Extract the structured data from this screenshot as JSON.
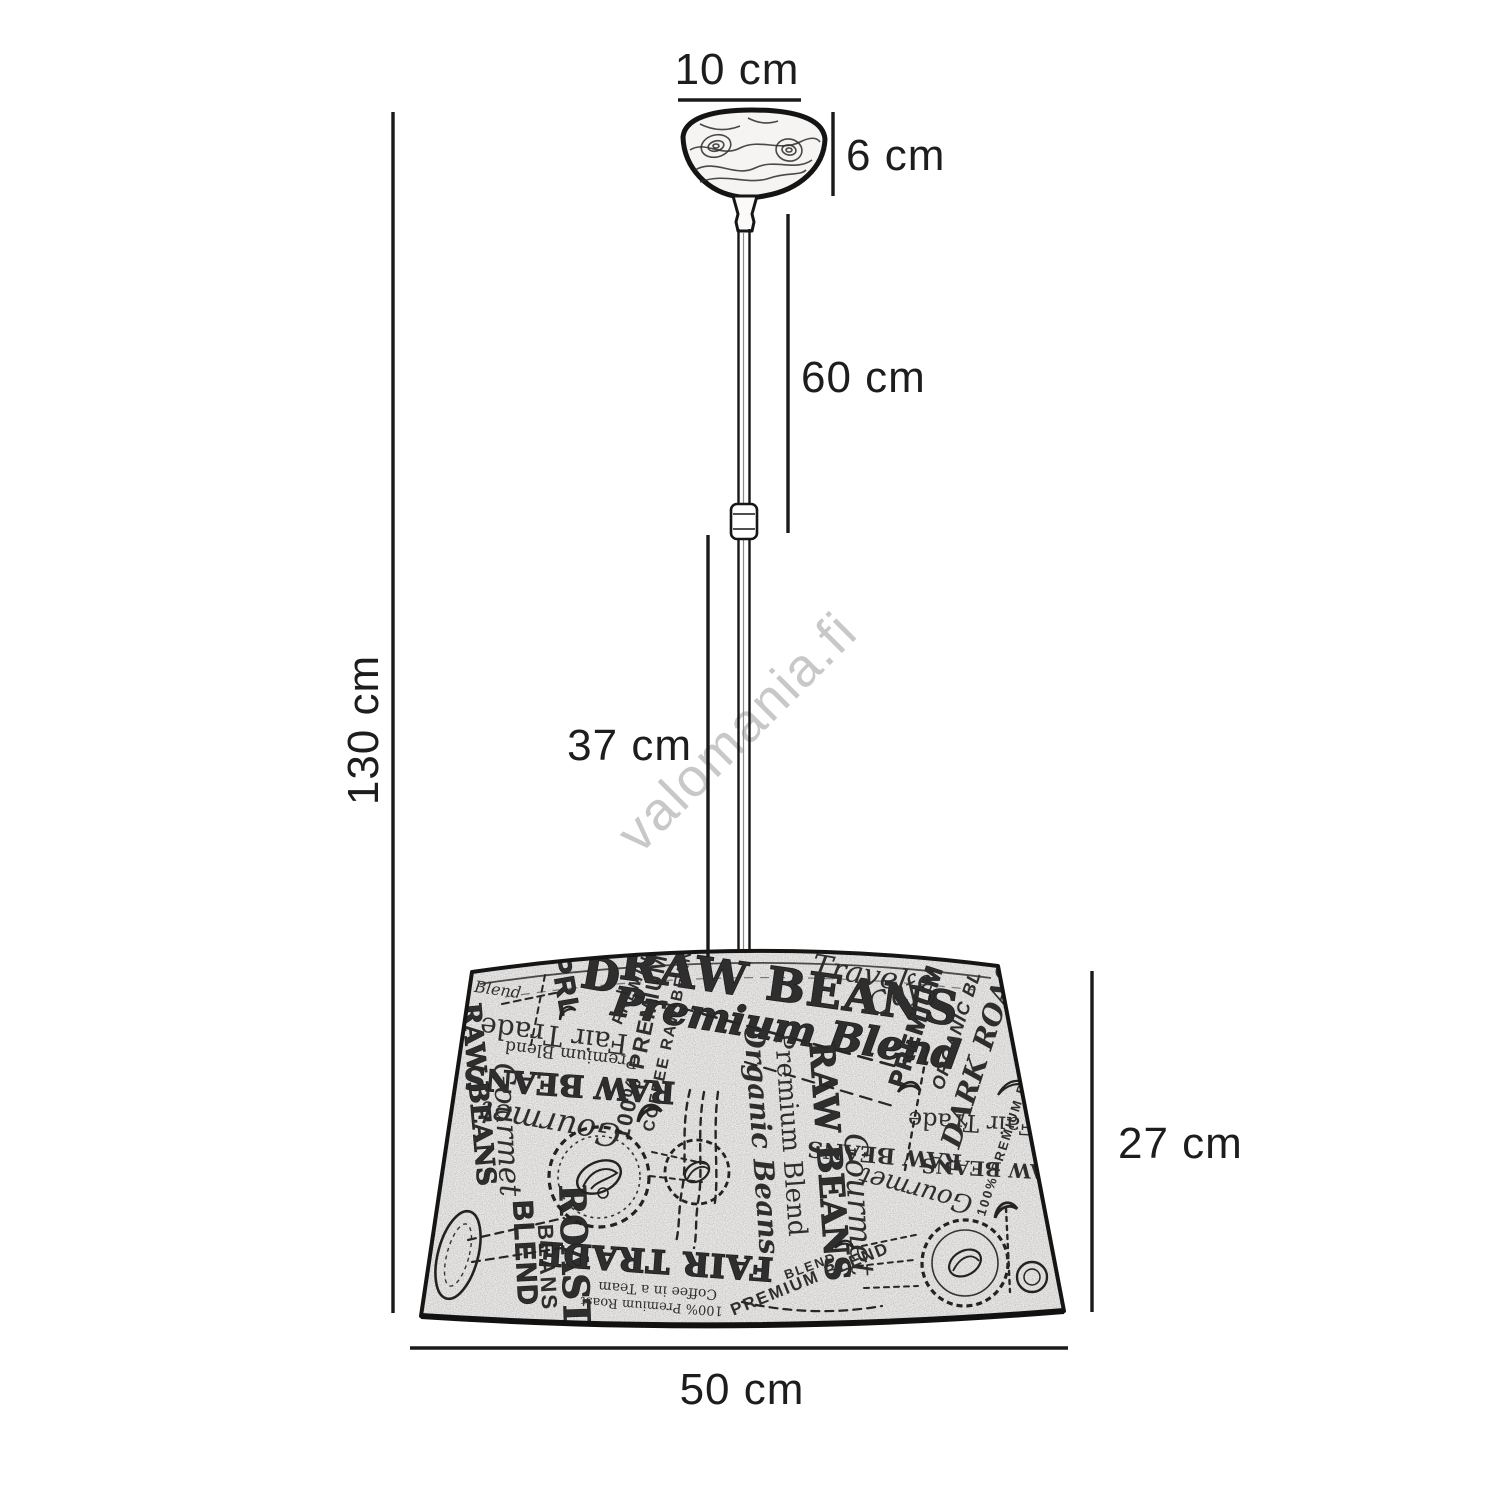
{
  "watermark": {
    "text": "valomania.fi"
  },
  "dimensions": {
    "canopy_width": "10 cm",
    "canopy_height": "6 cm",
    "cord_length": "60 cm",
    "total_height": "130 cm",
    "rod_length": "37 cm",
    "shade_height": "27 cm",
    "shade_diameter": "50 cm"
  },
  "colors": {
    "background": "#ffffff",
    "line": "#1a1a1a",
    "label_text": "#1d1d1d",
    "watermark": "#c8c8c8",
    "shade_fill": "#eeecea"
  },
  "shade_pattern": {
    "texts": [
      "RAW BEANS",
      "Premium Blend",
      "Fair Trade",
      "Premium Blend",
      "100% PREMIUM",
      "COFFEE RAW BEANS",
      "RAW BEANS",
      "Gourmet",
      "RAW BEANS",
      "Gourmet",
      "Organic Beans",
      "Premium Blend",
      "RAW BEANS",
      "Gourmet",
      "RAW BEANS",
      "PREMIUM B",
      "ORGANIC BL",
      "DARK ROAST",
      "Fair Trade",
      "RAW BEANS",
      "100% PREMIUM BLEND",
      "BLEND",
      "BEANS",
      "ROAST",
      "FAIR TRADE",
      "Coffee in a Team",
      "100% Premium Roast",
      "PREMIUM BLEND",
      "Blend",
      "Cafe",
      "PRL",
      "D",
      "PREMIUM",
      "Travel",
      "Gourmet",
      "BLEND"
    ]
  }
}
